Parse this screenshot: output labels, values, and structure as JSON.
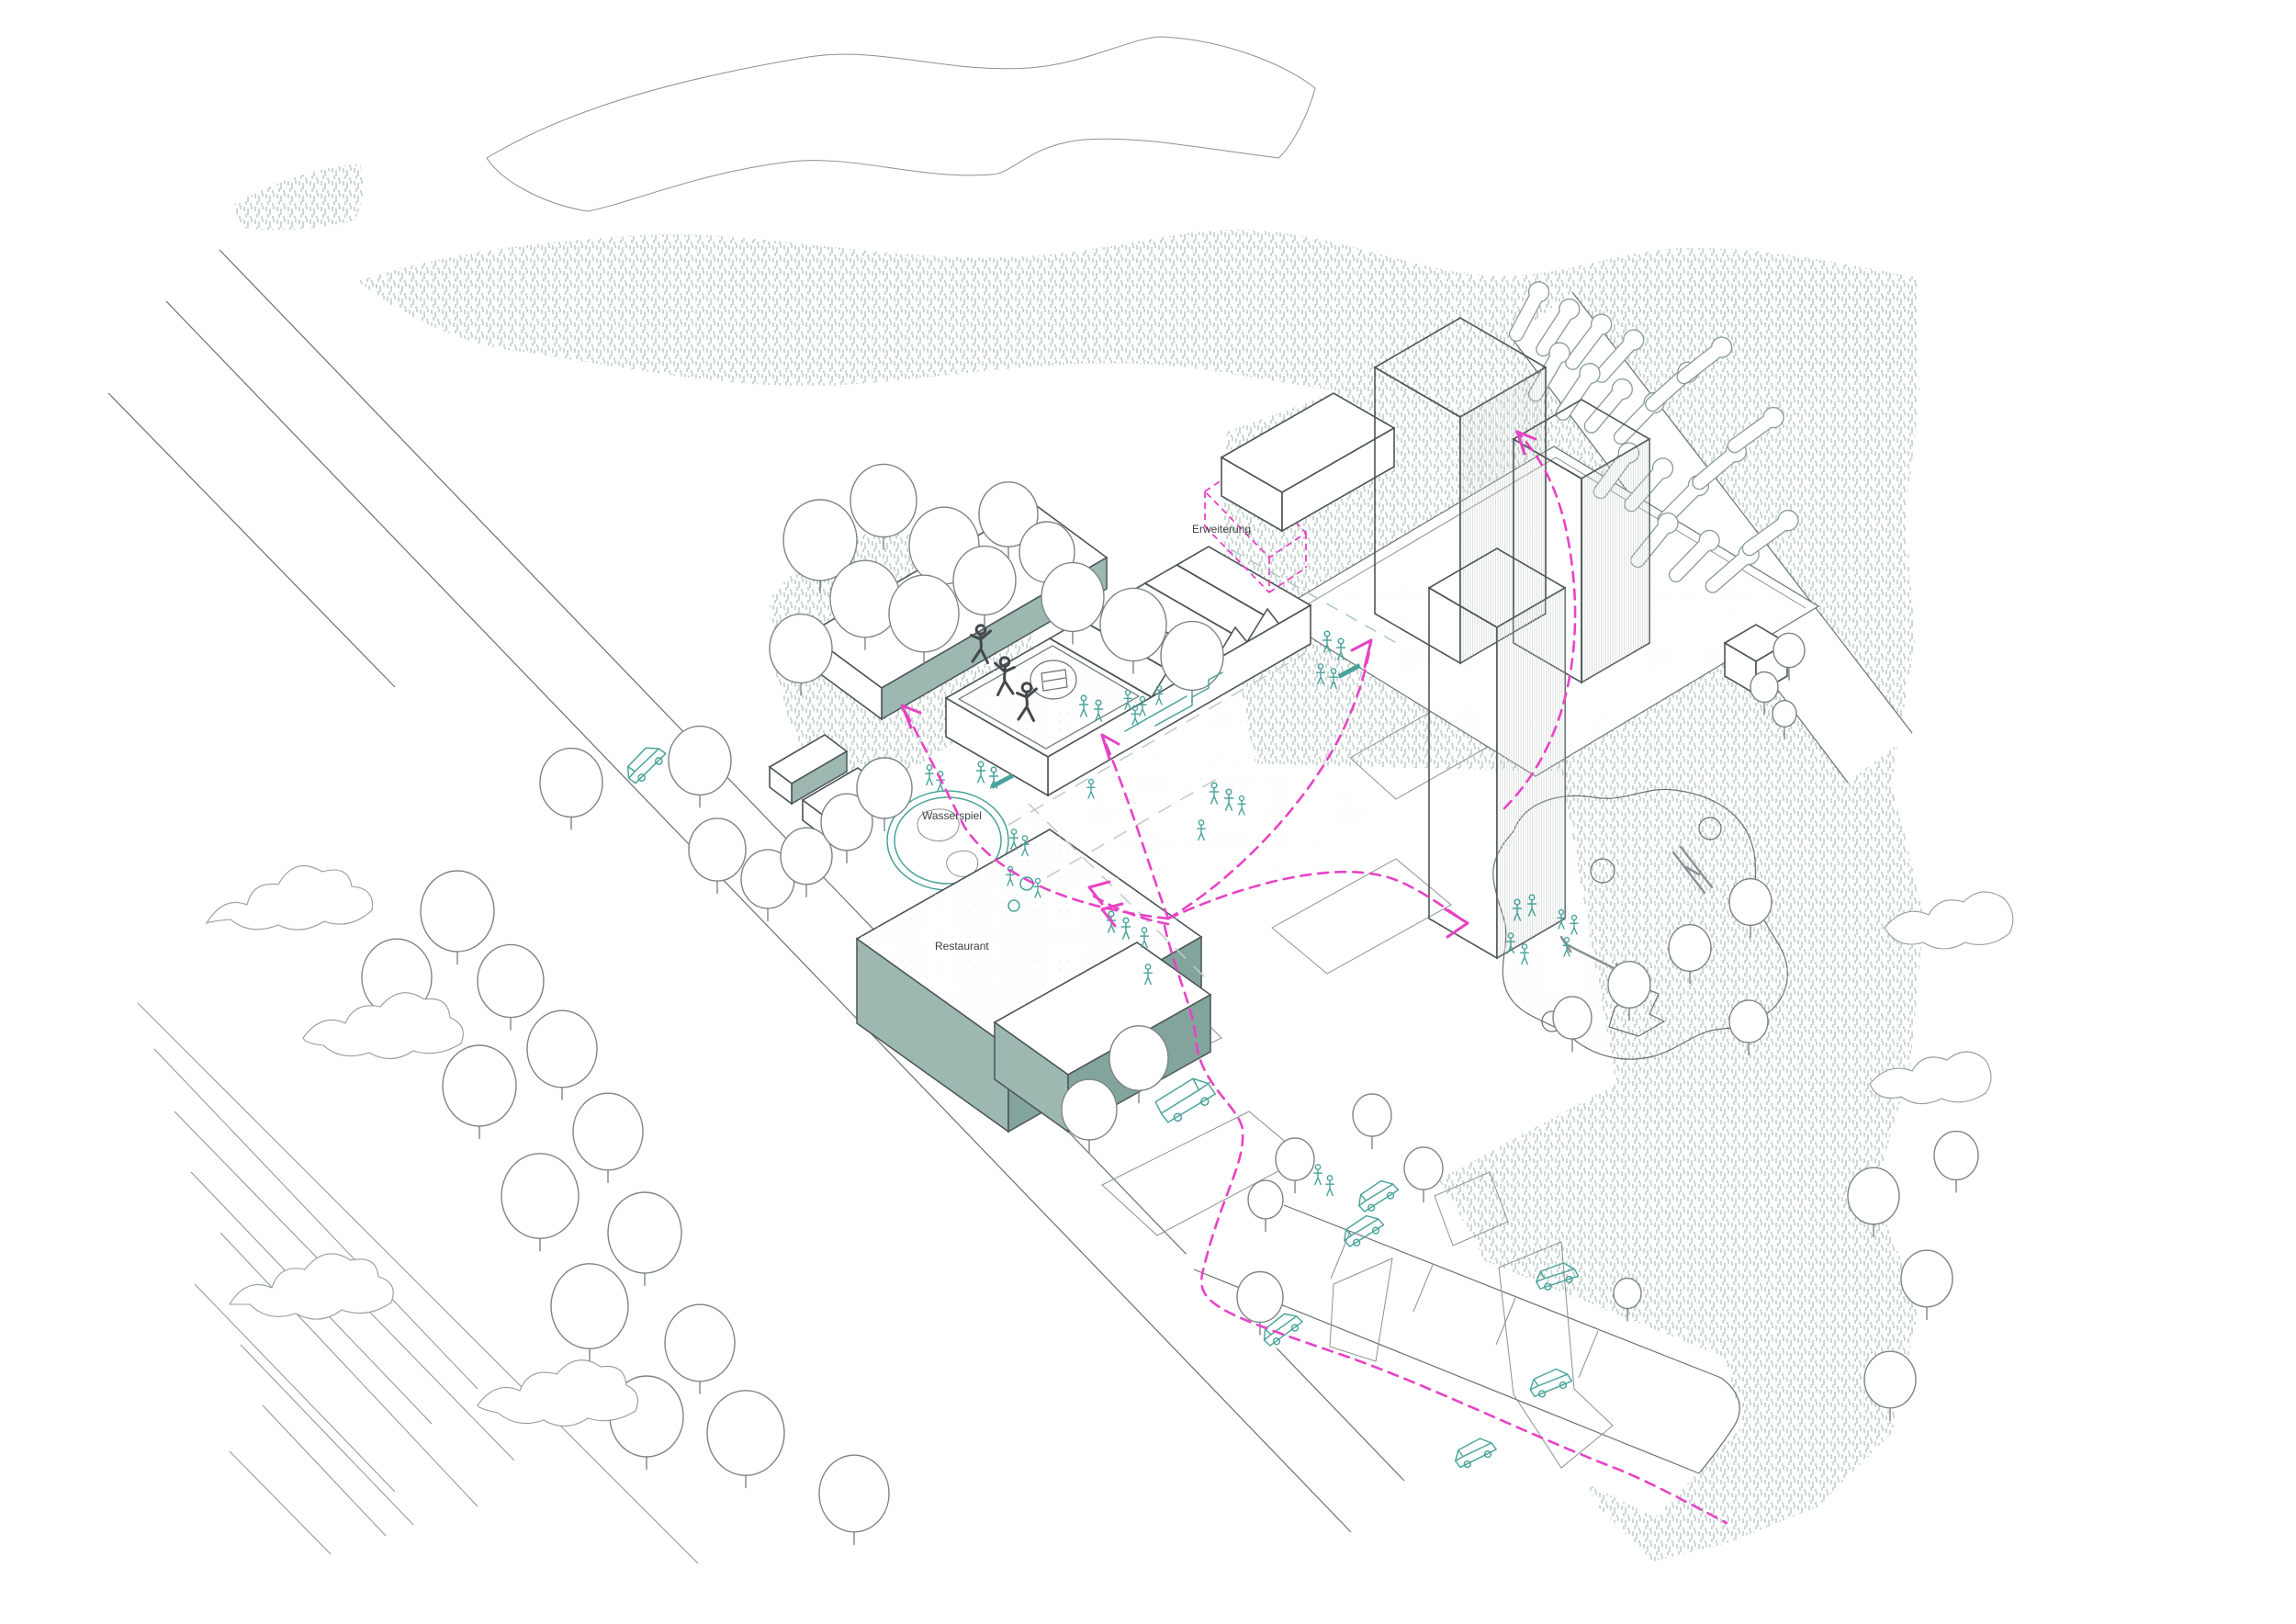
{
  "labels": {
    "extension": "Erweiterung",
    "water_feature": "Wasserspiel",
    "restaurant": "Restaurant"
  },
  "colors": {
    "background": "#ffffff",
    "hatch": "#a3b8b4",
    "sage": "#9cb8b1",
    "sage_dark": "#83a49d",
    "teal": "#4aa39a",
    "magenta": "#e743c5",
    "line": "#6a7173",
    "edge": "#4d5456",
    "tower_face_light": "#e8eceb",
    "tower_face_mid": "#dce1e0",
    "tower_face_dark": "#d0d7d5",
    "label_text": "#3a3f41"
  }
}
